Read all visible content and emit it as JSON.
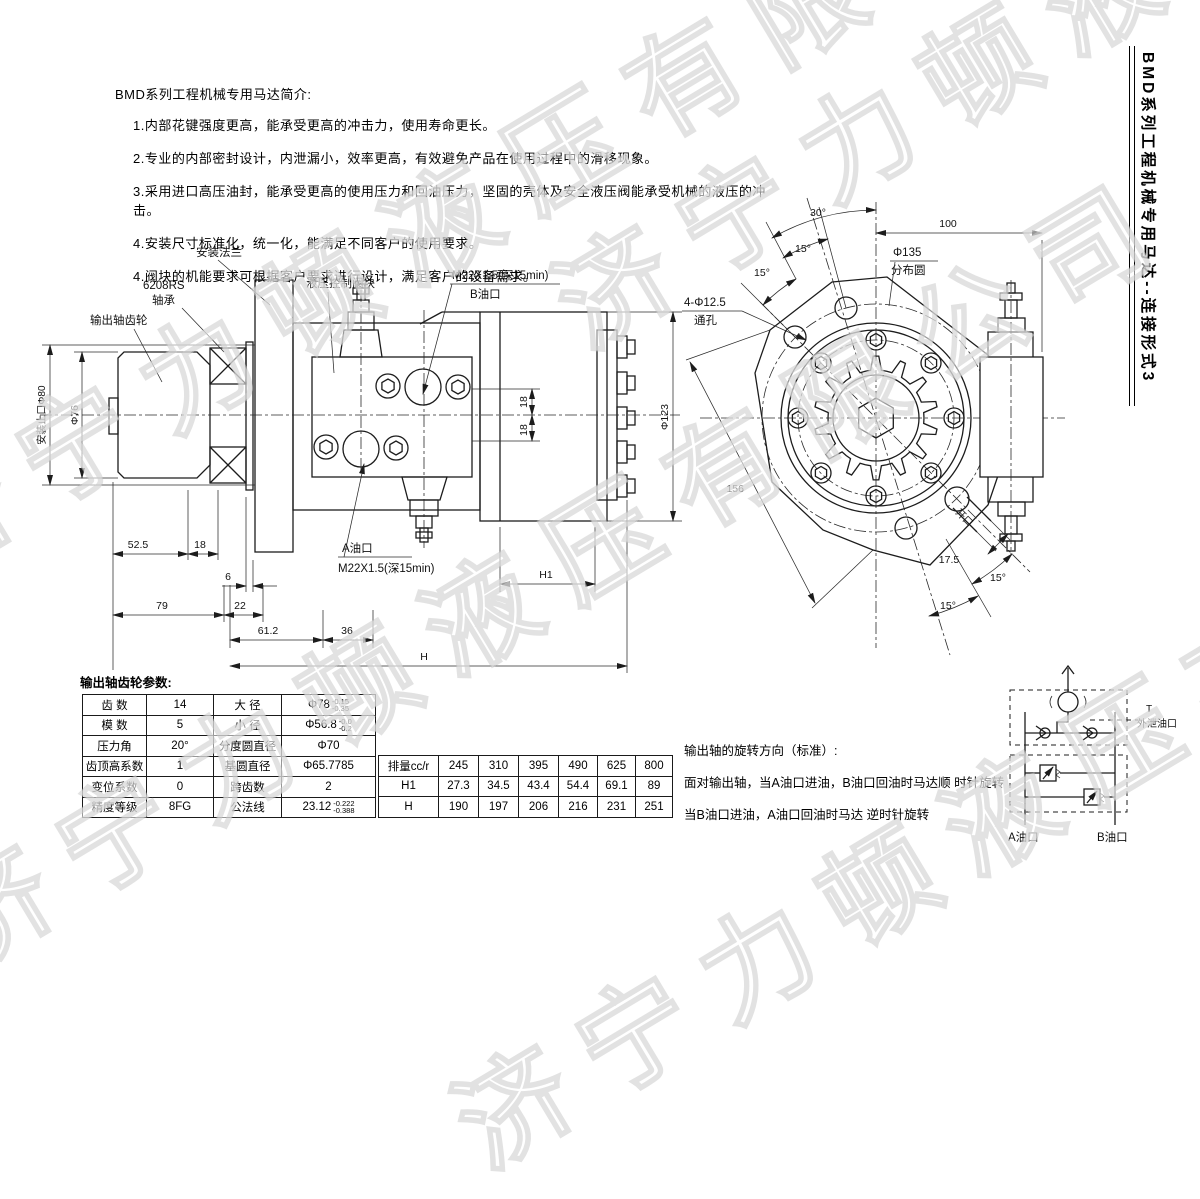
{
  "watermark": {
    "text": "济宁力顿液压有限公司"
  },
  "side_title": "BMD系列工程机械专用马达--连接形式3",
  "intro": {
    "title": "BMD系列工程机械专用马达简介:",
    "items": [
      "1.内部花键强度更高，能承受更高的冲击力，使用寿命更长。",
      "2.专业的内部密封设计，内泄漏小，效率更高，有效避免产品在使用过程中的滑移现象。",
      "3.采用进口高压油封，能承受更高的使用压力和回油压力，坚固的壳体及安全液压阀能承受机械的液压的冲击。",
      "4.安装尺寸标准化，统一化，能满足不同客户的使用要求。",
      "4.阀块的机能要求可根据客户要求进行设计，满足客户的设备需求。"
    ]
  },
  "left_view": {
    "labels": {
      "flange": "安装法兰",
      "bearing_model": "6208RS",
      "bearing": "轴承",
      "output_gear": "输出轴齿轮",
      "valve_block": "液压控制阀块",
      "b_port_thread": "M22X1.5(深15min)",
      "b_port": "B油口",
      "a_port": "A油口",
      "a_port_thread": "M22X1.5(深15min)"
    },
    "dims": {
      "pilot": "安装止口Φ80",
      "phi76": "Φ76",
      "phi123": "Φ123",
      "d52_5": "52.5",
      "d18": "18",
      "d6": "6",
      "d79": "79",
      "d22": "22",
      "d61_2": "61.2",
      "d36": "36",
      "h1": "H1",
      "h": "H"
    }
  },
  "right_view": {
    "dims": {
      "a30": "30°",
      "a15": "15°",
      "d100": "100",
      "phi135": "Φ135",
      "bolt_circle": "分布圆",
      "holes": "4-Φ12.5",
      "through": "通孔",
      "d156": "156",
      "d17_5": "17.5",
      "slot": "开口"
    }
  },
  "gear_params": {
    "title": "输出轴齿轮参数:",
    "rows": [
      {
        "p1": "齿  数",
        "v1": "14",
        "p2": "大  径",
        "v2": "Φ78",
        "t2a": "-0.15",
        "t2b": "-0.35"
      },
      {
        "p1": "模  数",
        "v1": "5",
        "p2": "小  径",
        "v2": "Φ56.8",
        "t2a": "-0.0",
        "t2b": "-0.2"
      },
      {
        "p1": "压力角",
        "v1": "20°",
        "p2": "分度圆直径",
        "v2": "Φ70",
        "t2a": "",
        "t2b": ""
      },
      {
        "p1": "齿顶高系数",
        "v1": "1",
        "p2": "基圆直径",
        "v2": "Φ65.7785",
        "t2a": "",
        "t2b": ""
      },
      {
        "p1": "变位系数",
        "v1": "0",
        "p2": "跨齿数",
        "v2": "2",
        "t2a": "",
        "t2b": ""
      },
      {
        "p1": "精度等级",
        "v1": "8FG",
        "p2": "公法线",
        "v2": "23.12",
        "t2a": "-0.222",
        "t2b": "-0.388"
      }
    ]
  },
  "disp_table": {
    "rows": [
      [
        "排量cc/r",
        "245",
        "310",
        "395",
        "490",
        "625",
        "800"
      ],
      [
        "H1",
        "27.3",
        "34.5",
        "43.4",
        "54.4",
        "69.1",
        "89"
      ],
      [
        "H",
        "190",
        "197",
        "206",
        "216",
        "231",
        "251"
      ]
    ]
  },
  "rotation": {
    "title": "输出轴的旋转方向（标准）:",
    "line1": "面对输出轴，当A油口进油，B油口回油时马达顺 时针旋转",
    "line2": "当B油口进油，A油口回油时马达 逆时针旋转"
  },
  "schematic": {
    "t": "T",
    "drain": "外泄油口",
    "a": "A油口",
    "b": "B油口"
  }
}
